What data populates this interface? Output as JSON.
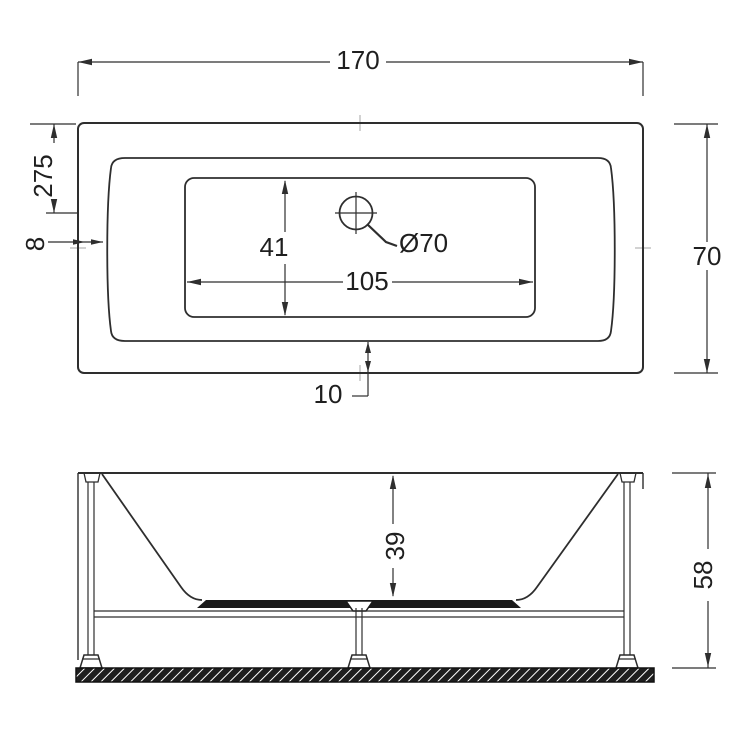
{
  "title": "Bathtub technical drawing (top view and front elevation)",
  "colors": {
    "line": "#2e2e2e",
    "background": "#ffffff",
    "solid_fill": "#1a1a1a",
    "centermark": "#b5b5b5"
  },
  "views": {
    "top": {
      "name": "top view",
      "dims": {
        "overall_length": "170",
        "overall_width": "70",
        "rim_to_drain": "275",
        "rim_edge": "8",
        "basin_width": "41",
        "basin_length": "105",
        "rim_bottom": "10",
        "drain_diameter": "Ø70"
      }
    },
    "front": {
      "name": "front view",
      "dims": {
        "basin_depth": "39",
        "overall_height": "58"
      }
    }
  }
}
